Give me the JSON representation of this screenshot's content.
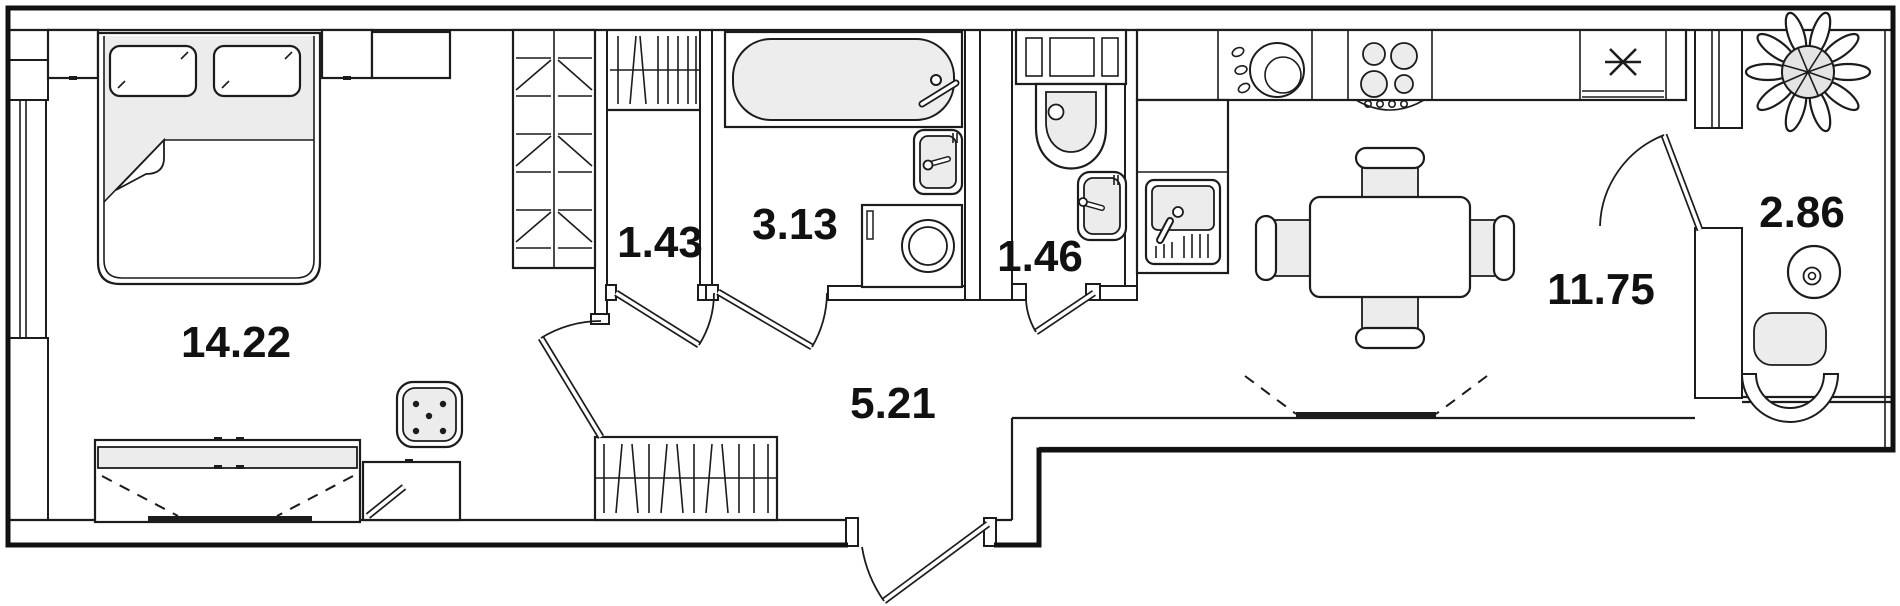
{
  "rooms": [
    {
      "id": "bedroom",
      "area": "14.22"
    },
    {
      "id": "closet",
      "area": "1.43"
    },
    {
      "id": "bathroom",
      "area": "3.13"
    },
    {
      "id": "wc",
      "area": "1.46"
    },
    {
      "id": "hallway",
      "area": "5.21"
    },
    {
      "id": "kitchen-living",
      "area": "11.75"
    },
    {
      "id": "balcony",
      "area": "2.86"
    }
  ],
  "colors": {
    "wall": "#1c1c1c",
    "line": "#1c1c1c",
    "furniture_fill": "#ececec",
    "background": "#ffffff"
  },
  "fixtures": [
    "double-bed",
    "pillow",
    "nightstand",
    "wardrobe",
    "dresser",
    "tv-stand",
    "pouf",
    "storage-cabinet",
    "coat-rack",
    "clothes-rail",
    "bathtub",
    "washbasin",
    "washing-machine",
    "toilet",
    "hand-basin",
    "kitchen-counter",
    "kitchen-sink",
    "cooktop",
    "refrigerator",
    "dining-table",
    "dining-chair",
    "window",
    "entrance-door",
    "interior-door",
    "plant",
    "balcony-table",
    "balcony-chair"
  ]
}
